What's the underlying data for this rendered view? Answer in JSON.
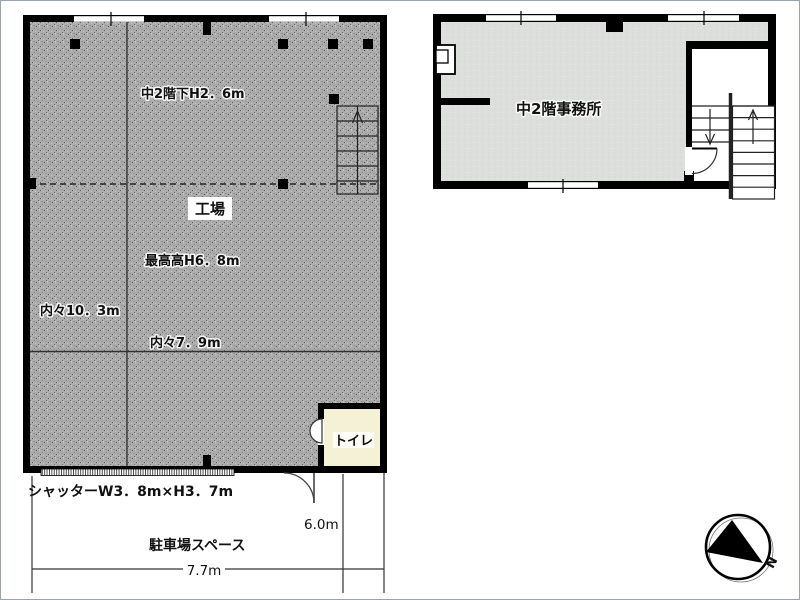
{
  "ground_floor": {
    "room": "工場",
    "mezzanine_under_height": "中2階下H2．6m",
    "max_height": "最高高H6．8m",
    "inner_width": "内々10．3m",
    "inner_depth": "内々7．9m",
    "toilet": "トイレ",
    "shutter": "シャッターW3．8m×H3．7m",
    "parking": "駐車場スペース",
    "parking_depth": "6.0m",
    "frontage": "7.7m"
  },
  "mezzanine_floor": {
    "room": "中2階事務所"
  },
  "compass": {
    "north": "N"
  },
  "colors": {
    "wall": "#000000",
    "factory_fill_base": "#acacac",
    "office_fill": "#dcdfdb",
    "toilet_fill": "#f5f1d6",
    "paper": "#ffffff"
  }
}
